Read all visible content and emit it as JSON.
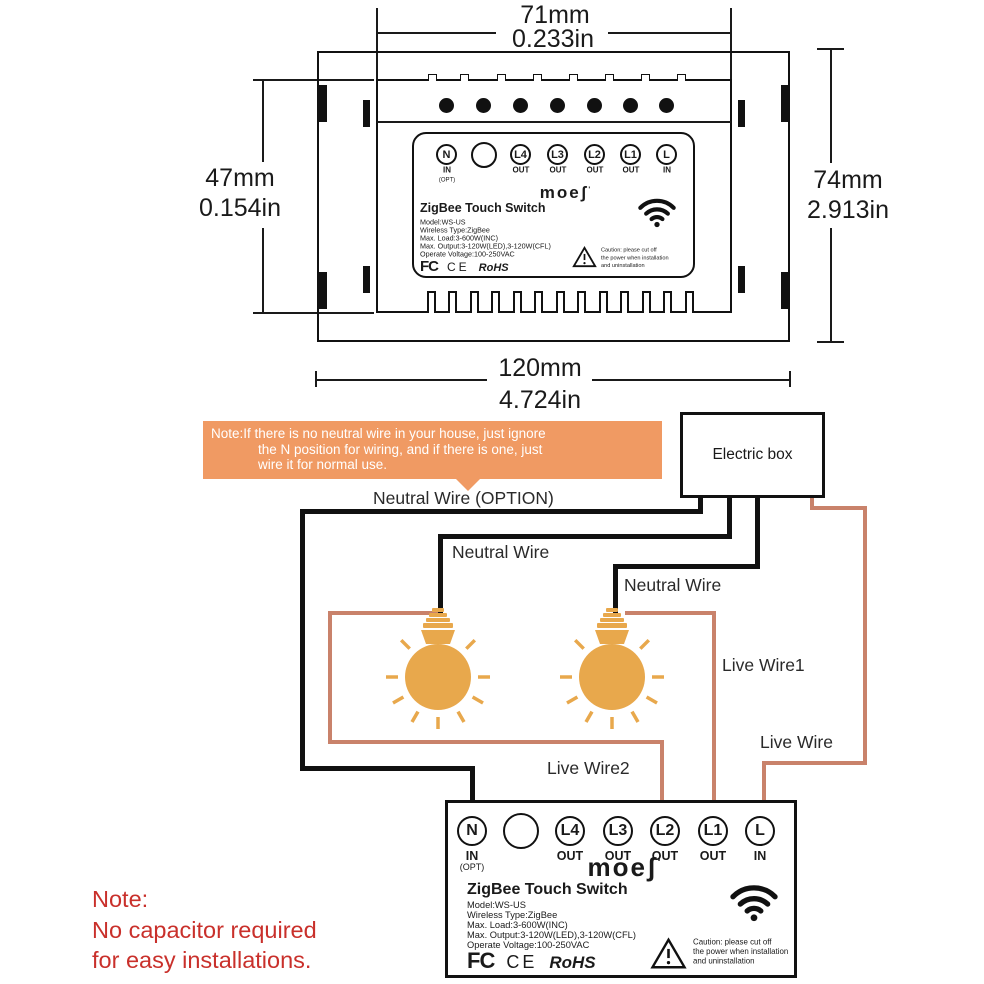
{
  "dimensions": {
    "top_mm": "71mm",
    "top_in": "0.233in",
    "left_mm": "47mm",
    "left_in": "0.154in",
    "right_mm": "74mm",
    "right_in": "2.913in",
    "bottom_mm": "120mm",
    "bottom_in": "4.724in"
  },
  "switch": {
    "brand": "moeʃ",
    "brand_mark": "'",
    "title": "ZigBee Touch Switch",
    "specs": [
      "Model:WS-US",
      "Wireless Type:ZigBee",
      "Max. Load:3-600W(INC)",
      "Max. Output:3-120W(LED),3-120W(CFL)",
      "Operate Voltage:100-250VAC"
    ],
    "terminals": [
      {
        "label": "N",
        "sub": "IN",
        "sub2": "(OPT)"
      },
      {
        "label": "",
        "sub": "",
        "sub2": ""
      },
      {
        "label": "L4",
        "sub": "OUT",
        "sub2": ""
      },
      {
        "label": "L3",
        "sub": "OUT",
        "sub2": ""
      },
      {
        "label": "L2",
        "sub": "OUT",
        "sub2": ""
      },
      {
        "label": "L1",
        "sub": "OUT",
        "sub2": ""
      },
      {
        "label": "L",
        "sub": "IN",
        "sub2": ""
      }
    ],
    "certs": {
      "fcc": "FC",
      "ce": "CE",
      "rohs": "RoHS"
    },
    "caution_lines": [
      "Caution: please cut off",
      "the power when installation",
      "and uninstallation"
    ]
  },
  "note_box": {
    "line1": "Note:If there is no neutral wire in your house, just ignore",
    "line2": "the N position for wiring, and if there is one, just",
    "line3": "wire it for normal use."
  },
  "wiring": {
    "electric_box": "Electric box",
    "neutral_wire_option": "Neutral Wire (OPTION)",
    "neutral_wire_1": "Neutral Wire",
    "neutral_wire_2": "Neutral Wire",
    "live_wire_1": "Live Wire1",
    "live_wire": "Live Wire",
    "live_wire_2": "Live Wire2"
  },
  "bottom_note": {
    "line1": "Note:",
    "line2": "No capacitor required",
    "line3": "for easy installations."
  },
  "colors": {
    "note_box_bg": "#F09A63",
    "live_wire": "#C9826B",
    "neutral_wire": "#111111",
    "bulb": "#E8A84C",
    "bottom_note_text": "#C9302B"
  }
}
